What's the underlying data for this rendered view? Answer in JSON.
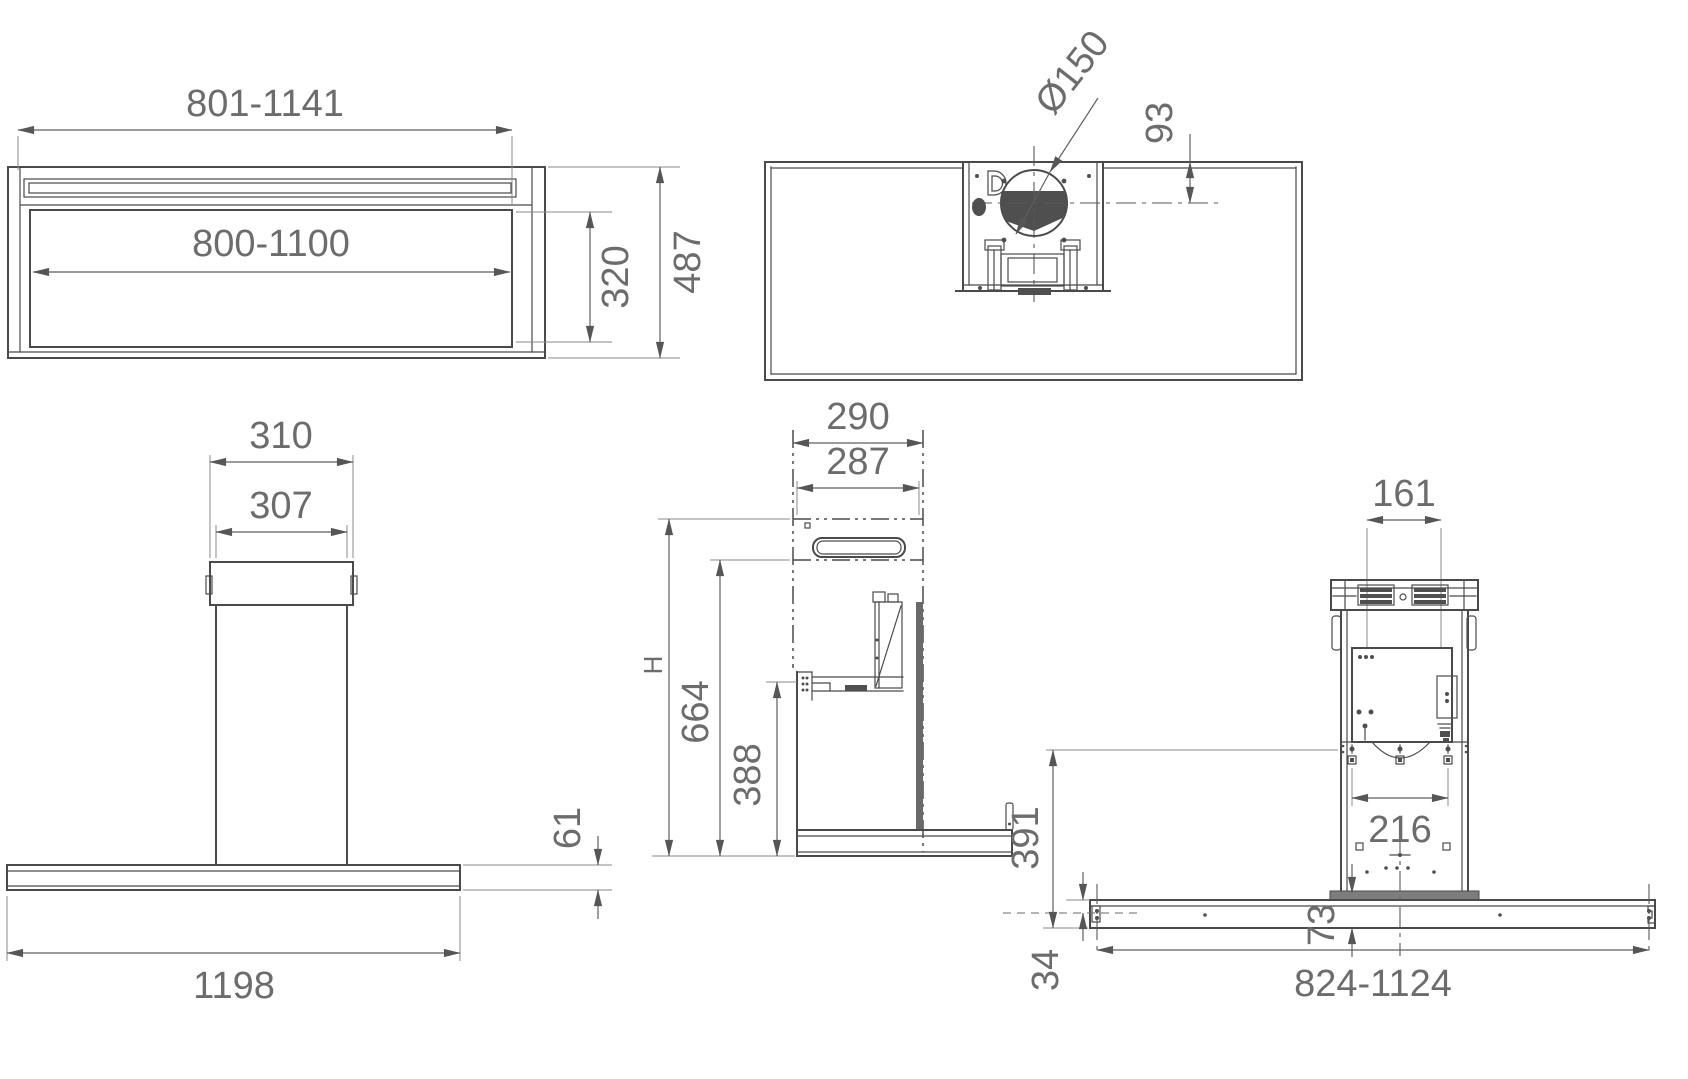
{
  "views": {
    "front_top": {
      "dims": {
        "outer_width": "801-1141",
        "inner_width": "800-1100",
        "inner_depth": "320",
        "overall_depth": "487"
      }
    },
    "top": {
      "dims": {
        "duct_diameter": "Ø150",
        "duct_offset": "93"
      }
    },
    "front": {
      "dims": {
        "bracket_width": "310",
        "chimney_width": "307",
        "canopy_height": "61",
        "canopy_width": "1198"
      }
    },
    "side": {
      "dims": {
        "chimney_depth": "290",
        "chimney_inner_depth": "287",
        "overall_height": "H",
        "upper_height": "664",
        "body_height": "388"
      }
    },
    "rear": {
      "dims": {
        "vent_spacing": "161",
        "screw_spacing": "216",
        "column_height": "391",
        "rail_offset": "34",
        "foot_height": "73",
        "rail_width": "824-1124"
      }
    }
  }
}
